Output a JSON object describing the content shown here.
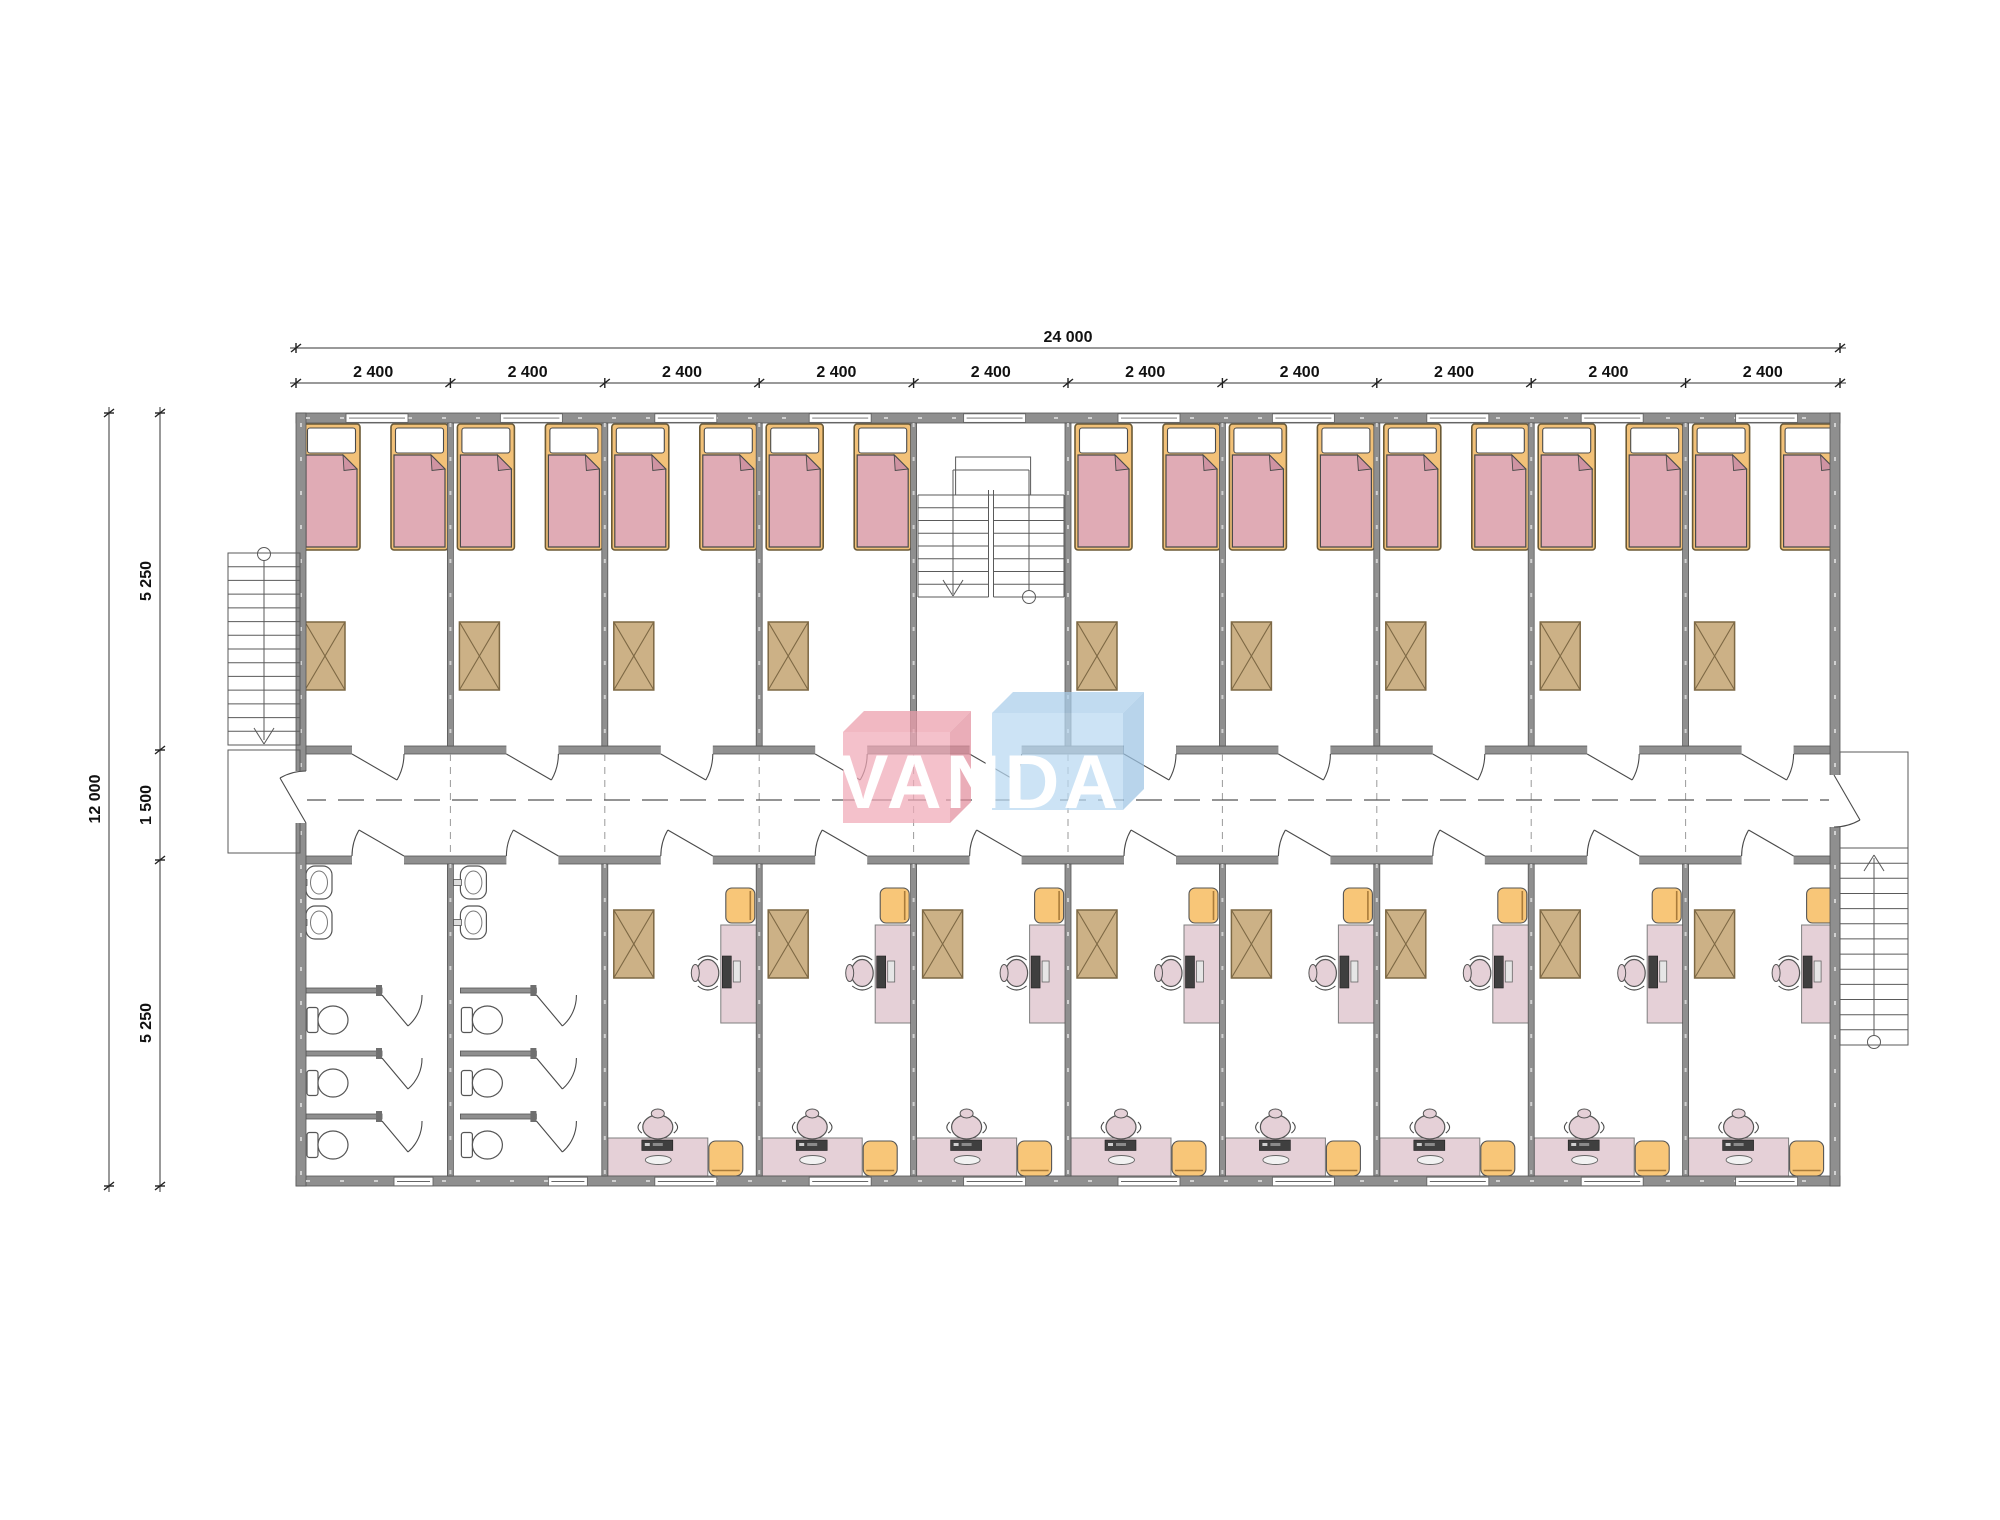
{
  "dimensions": {
    "top_total": "24 000",
    "top_segments": [
      "2 400",
      "2 400",
      "2 400",
      "2 400",
      "2 400",
      "2 400",
      "2 400",
      "2 400",
      "2 400",
      "2 400"
    ],
    "left_total": "12 000",
    "left_segments": [
      "5 250",
      "1 500",
      "5 250"
    ]
  },
  "logo": {
    "text": "VANDA",
    "pink_color": "#f0a9b7",
    "blue_color": "#b9d8f1"
  },
  "plan": {
    "module_count": 10,
    "building_width_mm": "24 000",
    "building_depth_mm": "12 000",
    "zone_depths_mm": [
      "5 250",
      "1 500",
      "5 250"
    ],
    "inventory": {
      "bedrooms": 9,
      "beds": 18,
      "bedside_tables_top_row": 9,
      "bathrooms": 2,
      "sinks_per_bathroom": 2,
      "toilet_stalls_per_bathroom": 3,
      "study_rooms": 8,
      "desks_per_study_room": 2,
      "office_chairs_per_study_room": 2,
      "orange_stools_per_study_room": 2,
      "side_tables_per_study_room": 1,
      "staircases": 3
    }
  },
  "colors": {
    "wall": "#8f8f8f",
    "bed_frame": "#f2c178",
    "bed_blanket": "#e0abb5",
    "bed_fold": "#cf93a2",
    "furniture_orange": "#f8c678",
    "desk_pink": "#e5d0d7",
    "table_brown": "#ccb186",
    "monitor_dark": "#3f3f3f",
    "line": "#444444"
  }
}
